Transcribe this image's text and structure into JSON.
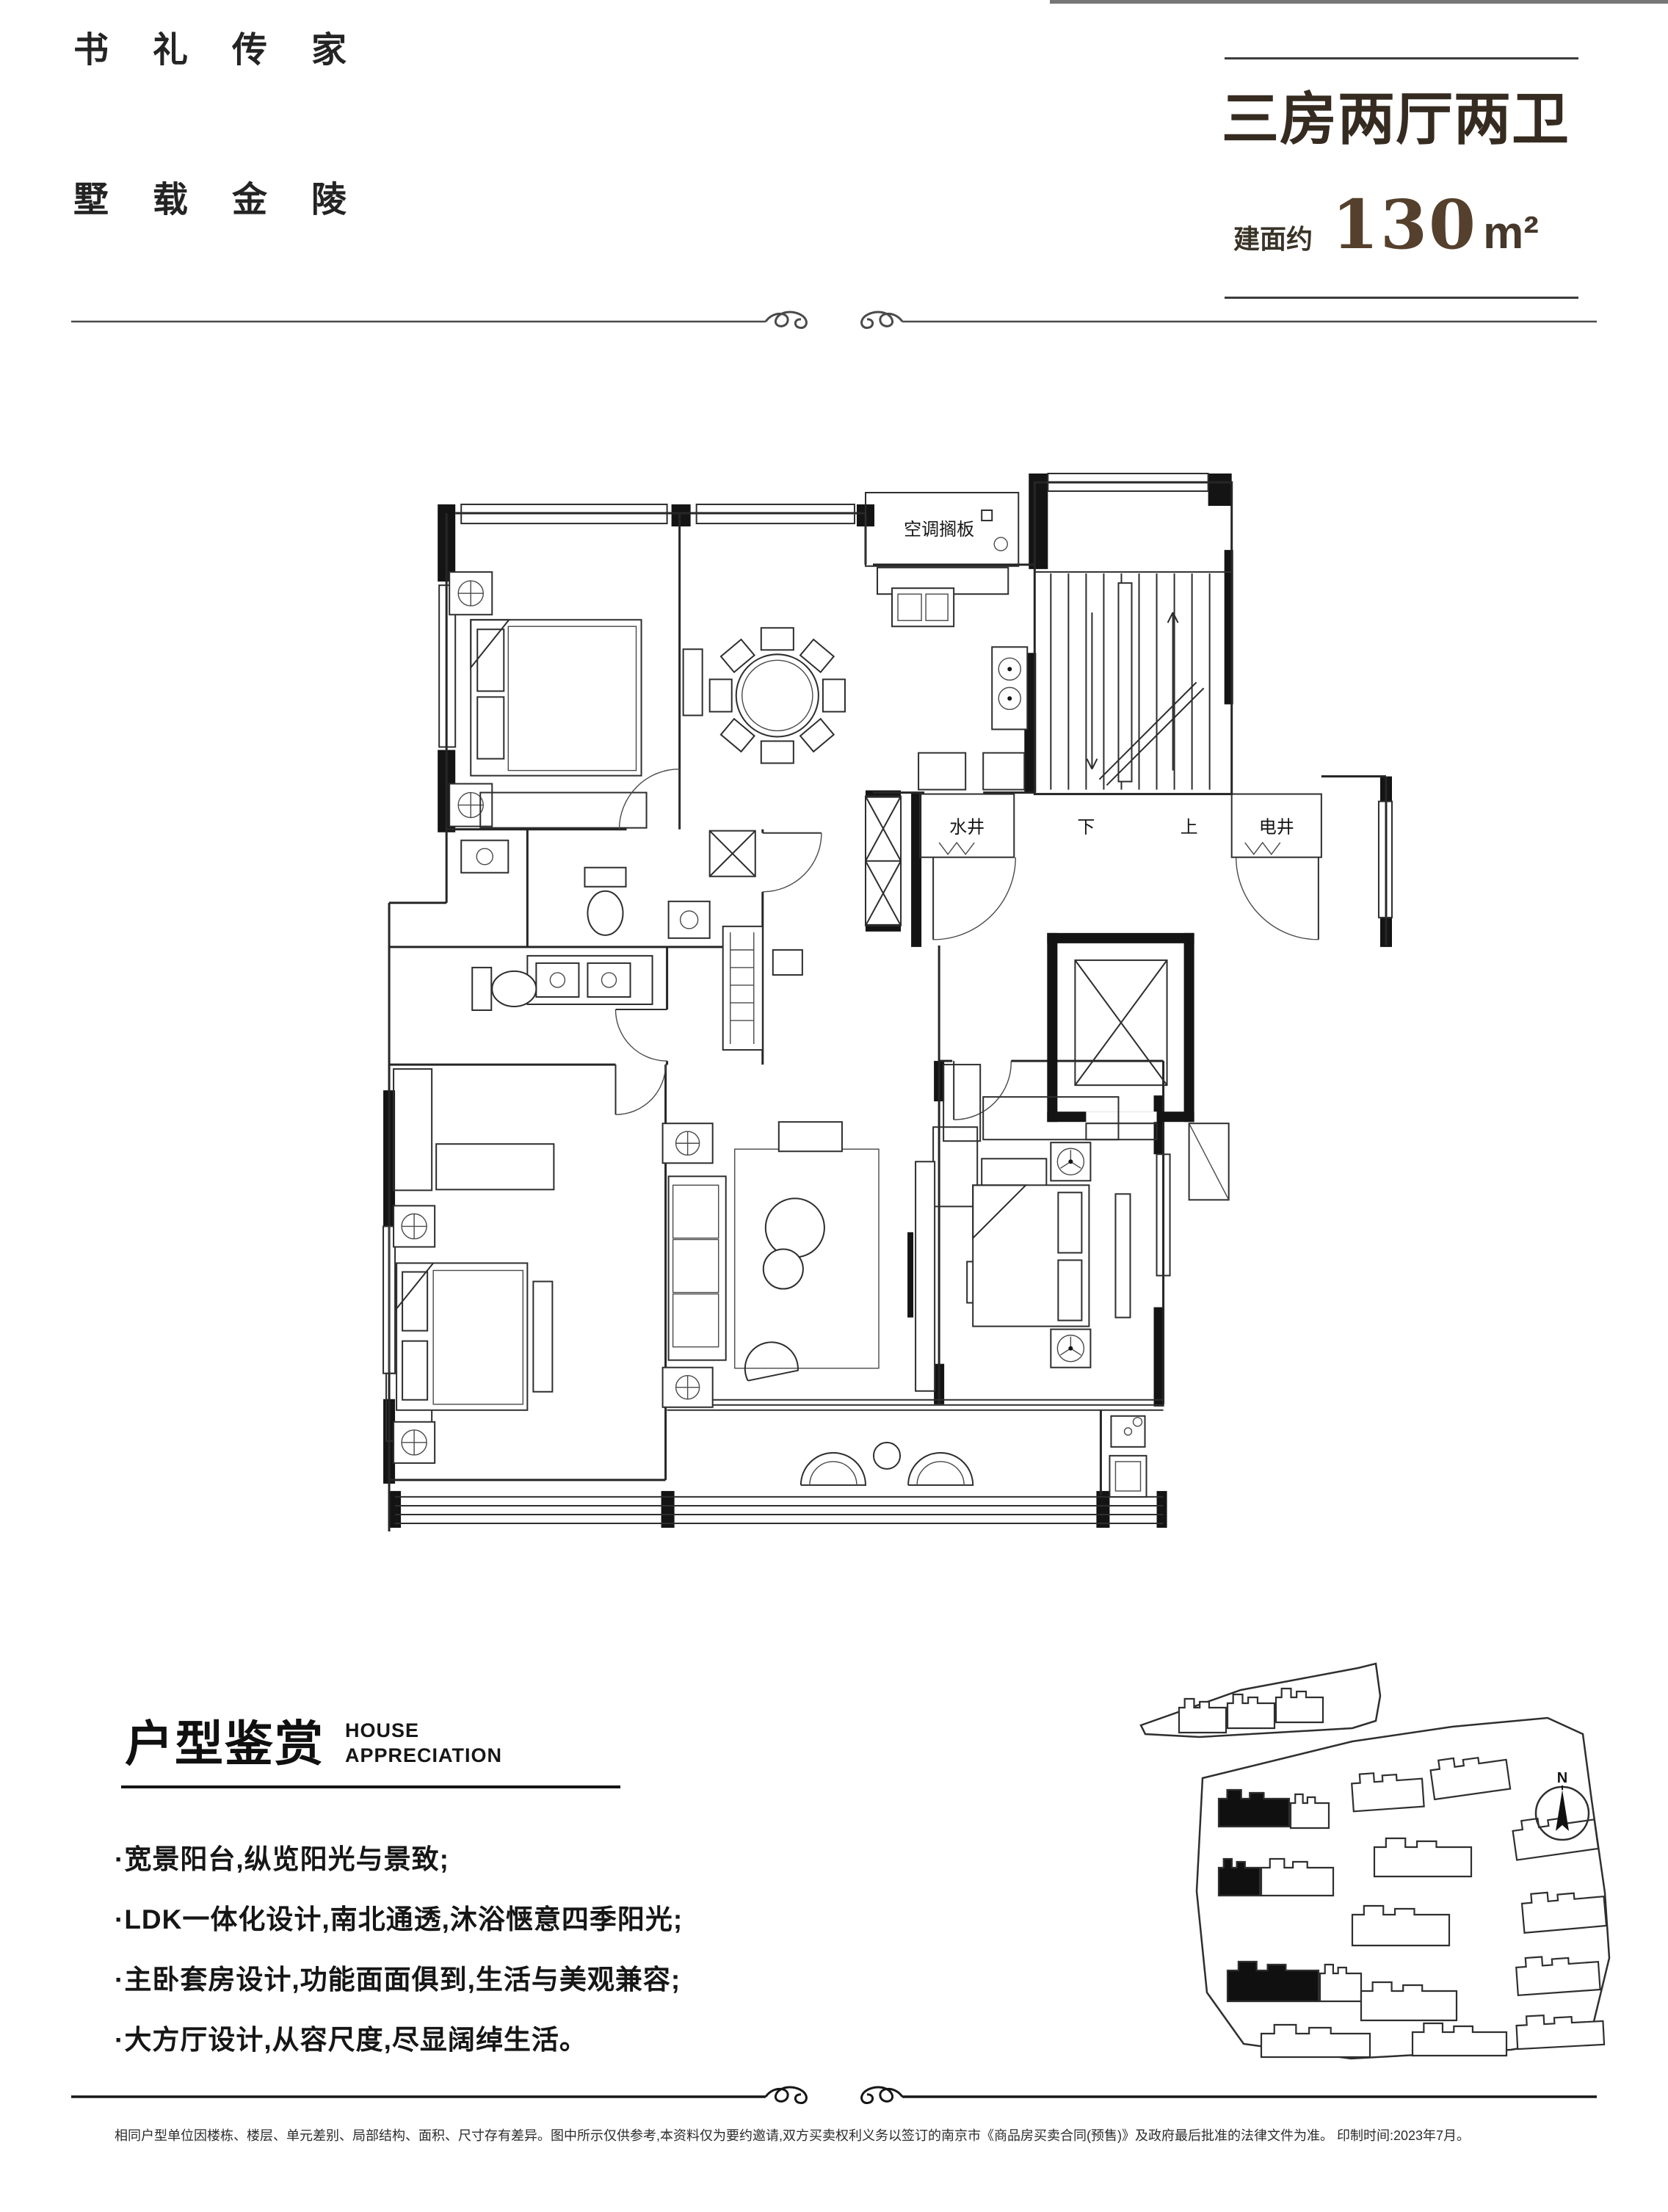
{
  "header": {
    "slogan_line1": "书礼传家",
    "slogan_line2": "墅载金陵",
    "unit_type": "三房两厅两卫",
    "area_label": "建面约",
    "area_value": "130",
    "area_unit": "m²"
  },
  "floor_plan": {
    "labels": {
      "ac_shelf": "空调搁板",
      "water_shaft": "水井",
      "down": "下",
      "up": "上",
      "electric_shaft": "电井"
    }
  },
  "appreciation": {
    "title_cn": "户型鉴赏",
    "title_en_line1": "HOUSE",
    "title_en_line2": "APPRECIATION",
    "bullets": [
      "·宽景阳台,纵览阳光与景致;",
      "·LDK一体化设计,南北通透,沐浴惬意四季阳光;",
      "·主卧套房设计,功能面面俱到,生活与美观兼容;",
      "·大方厅设计,从容尺度,尽显阔绰生活。"
    ]
  },
  "site_map": {
    "compass_label": "N"
  },
  "footer": {
    "disclaimer": "相同户型单位因楼栋、楼层、单元差别、局部结构、面积、尺寸存有差异。图中所示仅供参考,本资料仅为要约邀请,双方买卖权利义务以签订的南京市《商品房买卖合同(预售)》及政府最后批准的法律文件为准。 印制时间:2023年7月。"
  },
  "colors": {
    "headline_brown": "#362b20",
    "area_bronze": "#54402c",
    "text_dark": "#1c1c1c"
  }
}
